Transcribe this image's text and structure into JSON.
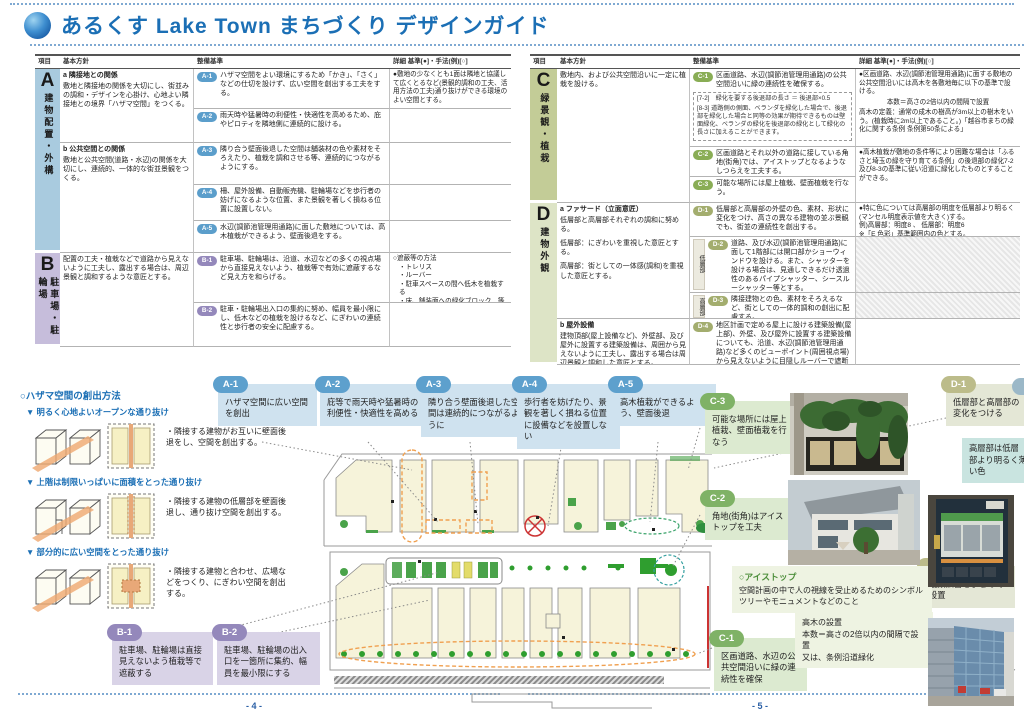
{
  "header": {
    "title": "あるくす Lake Town まちづくり デザインガイド"
  },
  "table_headers": {
    "item": "項目",
    "policy": "基本方針",
    "standard": "整備基準",
    "detail": "詳細 基準[●]・手法(例)[○]"
  },
  "sectionA": {
    "letter": "A",
    "name": "建物配置・外構",
    "policy_a_title": "a 隣接地との関係",
    "policy_a_body": "敷地と隣接地の関係を大切にし、街並みの調和・デザインを心掛け、心地よい隣接地との境界「ハザマ空間」をつくる。",
    "policy_b_title": "b 公共空間との関係",
    "policy_b_body": "敷地と公共空間(道路・水辺)の関係を大切にし、連続的、一体的な街並景観をつくる。",
    "items": [
      {
        "id": "A-1",
        "text": "ハザマ空間をよい環境にするため「かき」、「さく」などの仕切を設けず、広い空間を創出する工夫をする。"
      },
      {
        "id": "A-2",
        "text": "雨天時や猛暑時の利便性・快適性を高めるため、庇やピロティを隣地側に連続的に設ける。"
      },
      {
        "id": "A-3",
        "text": "隣り合う壁面後退した空間は舗装材の色や素材をそろえたり、植栽を調和させる等、連続的につながるようにする。"
      },
      {
        "id": "A-4",
        "text": "柵、屋外設備、自動販売機、駐輪場などを歩行者の妨げになるような位置、また景観を著しく損ねる位置に設置しない。"
      },
      {
        "id": "A-5",
        "text": "水辺(調節池管理用通路)に面した敷地については、高木植栽ができるよう、壁面後退をする。"
      }
    ],
    "detail": "●敷地の少なくとも1面は隣地と協議して広くとるなど(景観的調和の工夫、活用方法の工夫)通り抜けができる環境のよい空間とする。"
  },
  "sectionB": {
    "letter": "B",
    "name": "駐車場・駐輪場",
    "policy": "配置の工夫・植栽などで道路から見えないように工夫し、露出する場合は、周辺景観と調和するような意匠とする。",
    "items": [
      {
        "id": "B-1",
        "text": "駐車場、駐輪場は、沿道、水辺などの多くの視点場から直接見えないよう、植栽等で有効に遮蔽するなど見え方を和らげる。"
      },
      {
        "id": "B-2",
        "text": "駐車・駐輪場出入口の集約に努め、幅員を最小限にし、低木などの植栽を設けるなど、にぎわいの連続性と歩行者の安全に配慮する。"
      }
    ],
    "detail_title": "○遮蔽等の方法",
    "detail_items": [
      "・トレリス",
      "・ルーバー",
      "・駐車スペースの間へ低木を植栽する",
      "・床、舗装面への緑化ブロック　等"
    ]
  },
  "sectionC": {
    "letter": "C",
    "name": "緑景観・植栽",
    "policy": "敷地内、および公共空間沿いに一定に植栽を設ける。",
    "items": [
      {
        "id": "C-1",
        "text": "区画道路、水辺(調節池管理用通路)の公共空間沿いに緑の連続性を確保する。"
      },
      {
        "id": "C-2",
        "text": "区画道路とそれ以外の道路に接している角地(街角)では、アイストップとなるようなしつらえを工夫する。"
      },
      {
        "id": "C-3",
        "text": "可能な場所には屋上植栽、壁面植栽を行なう。"
      }
    ],
    "note_72": "[7-2]　緑化を要する後退部の長さ ＝ 後退部×0.5",
    "note_83": "[8-3] 道路側の側面、ベランダを緑化した場合で、後退部を緑化した場合と同等の効果が期待できるものは壁面緑化、ベランダの緑化を後退部の緑化として緑化の長さに加えることができます。",
    "detail1": "●区画道路、水辺(調節池管理用通路)に面する敷地の公共空間沿いには高木を各敷地毎に以下の基準で設ける。",
    "detail2": "本数＝高さの2倍以内の間隔で設置",
    "detail3": "高木の定義：通常の成木の樹高が3m以上の樹木をいう。(植栽時に2m以上であること。)「越谷市まちの緑化に関する条例 条例第50条による」",
    "detail4": "●高木植栽が敷地の条件等により困難な場合は「ふるさと埼玉の緑を守り育てる条例」の後退部の緑化7-2及び8-3の基準に従い沿道に緑化したものとすることができる。"
  },
  "sectionD": {
    "letter": "D",
    "name": "建物外観",
    "policy_a_title": "a ファサード（立面意匠）",
    "policy_a_body": "低層部と高層部それぞれの調和に努める。",
    "policy_low": "低層部：にぎわいを重視した意匠とする。",
    "policy_high": "高層部：街としての一体感(調和)を重視した意匠とする。",
    "policy_b_title": "b 屋外設備",
    "policy_b_body": "建物頂部(屋上設備など)、外壁部、及び屋外に設置する建築設備は、周囲から見えないように工夫し、露出する場合は周辺景観と調和した意匠とする。",
    "items": [
      {
        "id": "D-1",
        "tag": "",
        "text": "低層部と高層部の外壁の色、素材、形状に変化をつけ、高さの異なる建物の並ぶ景観でも、街並の連続性を創出する。"
      },
      {
        "id": "D-2",
        "tag": "低層部",
        "text": "道路、及び水辺(調節池管理用通路)に面して1階部には開口部かショーウィンドウを設ける。また、シャッターを設ける場合は、見通しできるだけ透過性のあるパイプシャッター、シースルーシャッター等とする。"
      },
      {
        "id": "D-3",
        "tag": "高層部",
        "text": "隣接建物との色、素材をそろえるなど、街としての一体的調和の創出に配慮する。"
      },
      {
        "id": "D-4",
        "tag": "",
        "text": "地区計画で定める屋上に設ける建築設備(屋上部)、外壁、及び屋外に設置する建築設備についても、沿道、水辺(調節池管理用通路)など多くのビューポイント(周囲視点場)から見えないように目隠しルーバーで遮断するなど配慮する。"
      }
    ],
    "detail1": "●特に色については高層部の明度を低層部より明るく(マンセル明度表示値を大きく)する。",
    "detail2": "例)高層部：明度8 、 低層部：明度6",
    "detail3": "※「E 色彩」基準範囲内の色とする。"
  },
  "hazama": {
    "title": "○ハザマ空間の創出方法",
    "rows": [
      {
        "heading": "▼ 明るく心地よいオープンな通り抜け",
        "caption": "・隣接する建物がお互いに壁面後退をし、空間を創出する。"
      },
      {
        "heading": "▼ 上階は制限いっぱいに面積をとった通り抜け",
        "caption": "・隣接する建物の低層部を壁面後退し、通り抜け空間を創出する。"
      },
      {
        "heading": "▼ 部分的に広い空間をとった通り抜け",
        "caption": "・隣接する建物と合わせ、広場などをつくり、にぎわい空間を創出する。"
      }
    ]
  },
  "callouts": {
    "a1": {
      "id": "A-1",
      "text": "ハザマ空間に広い空間を創出"
    },
    "a2": {
      "id": "A-2",
      "text": "庇等で雨天時や猛暑時の利便性・快適性を高める"
    },
    "a3": {
      "id": "A-3",
      "text": "隣り合う壁面後退した空間は連続的につながるように"
    },
    "a4": {
      "id": "A-4",
      "text": "歩行者を妨げたり、景観を著しく損ねる位置に設備などを設置しない"
    },
    "a5": {
      "id": "A-5",
      "text": "高木植栽ができるよう、壁面後退"
    },
    "b1": {
      "id": "B-1",
      "text": "駐車場、駐輪場は直接見えないよう植栽等で遮蔽する"
    },
    "b2": {
      "id": "B-2",
      "text": "駐車場、駐輪場の出入口を一箇所に集約、幅員を最小限にする"
    },
    "c1": {
      "id": "C-1",
      "text": "区画道路、水辺の公共空間沿いに緑の連続性を確保"
    },
    "c2": {
      "id": "C-2",
      "text": "角地(街角)はアイストップを工夫"
    },
    "c3": {
      "id": "C-3",
      "text": "可能な場所には屋上植栽、壁面植栽を行なう"
    },
    "d1": {
      "id": "D-1",
      "text": "低層部と高層部の変化をつける"
    },
    "d1_sub": "高層部は低層部より明るく薄い色",
    "f1": {
      "id": "F-1",
      "text": "複数広告をまとめて設置"
    }
  },
  "eyestop": {
    "title": "○アイストップ",
    "body": "空間計画の中で人の視線を受止めるためのシンボルツリーやモニュメントなどのこと"
  },
  "takagi": {
    "line1": "高木の設置",
    "line2": "本数＝高さの2倍以内の間隔で設置",
    "line3": "又は、条例沿道緑化"
  },
  "pages": {
    "left": "- 4 -",
    "right": "- 5 -"
  },
  "colors": {
    "accent_blue": "#1b6fb5",
    "badge_a": "#5da0cd",
    "badge_b": "#9488bb",
    "badge_c": "#7fb266",
    "badge_d": "#bcbc8a"
  }
}
